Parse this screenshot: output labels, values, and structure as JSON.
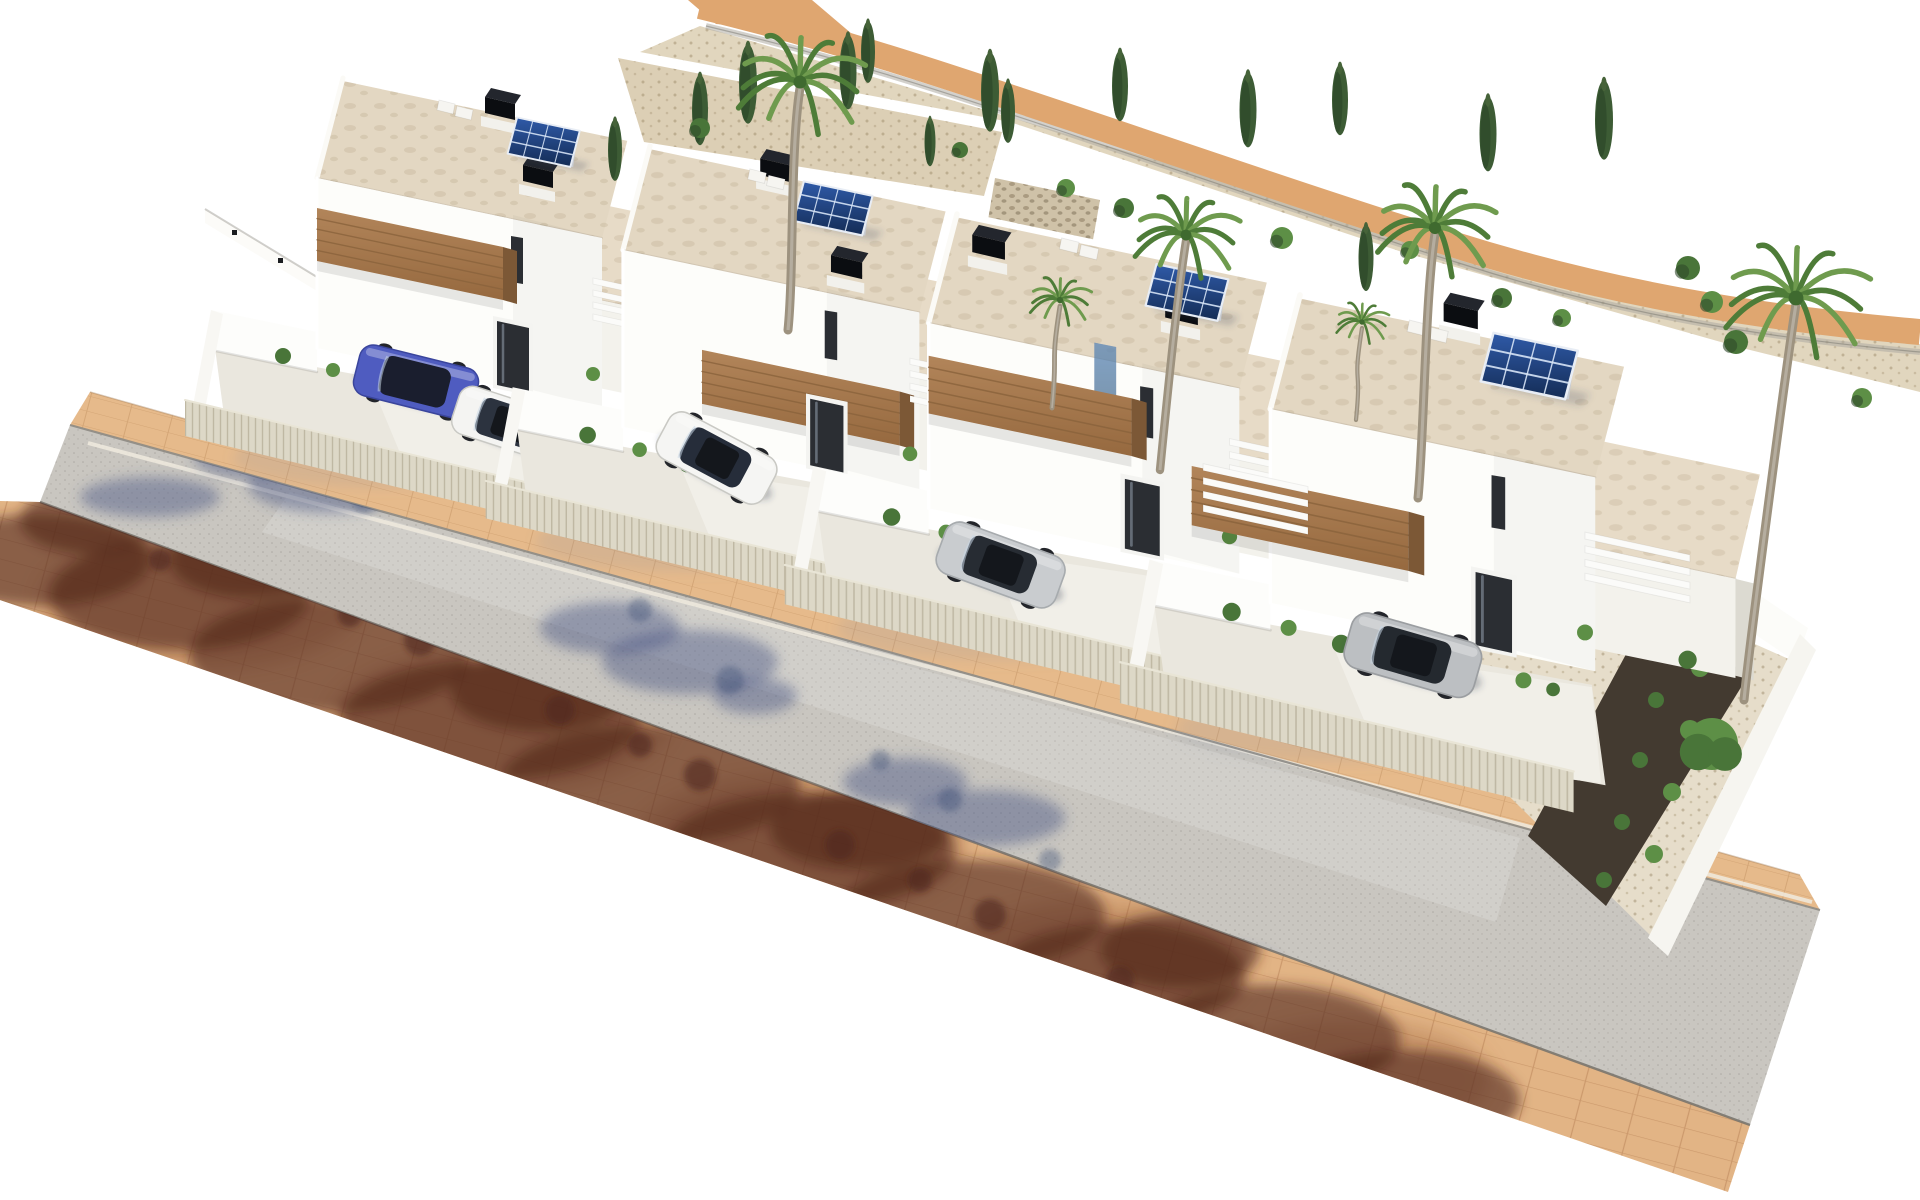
{
  "image": {
    "kind": "aerial-3d-architectural-render",
    "width": 1920,
    "height": 1200,
    "viewbox": "0 0 1920 1200",
    "background": "#ffffff"
  },
  "palette": {
    "roof1": "#e3d7c2",
    "roof2": "#e7dbc7",
    "wallBright": "#fdfdfa",
    "wallShade": "#f3f2ec",
    "wallDim": "#e9e7df",
    "alley": "#dcdad1",
    "woodTop": "#b2855a",
    "woodBottom": "#96693f",
    "woodSide": "#7c5836",
    "woodLine": "#8a633c",
    "doorDark": "#2b2e33",
    "doorFrame": "#f4f4f1",
    "glassBlue1": "#77a3c2",
    "glassBlue2": "#3f6f94",
    "floor": "#eae7de",
    "drive": "#f2f0e9",
    "fence": "#ddd8c7",
    "fenceEdge": "#e9e5d6",
    "road": "#c9c6c0",
    "sideTan": "#e6ba8b",
    "sideTan2": "#e2b485",
    "curbDark": "#8e8b84",
    "curbLight": "#f0ebdf",
    "roadEdge": "#75726b",
    "pathTan": "#dfa670",
    "gravel": "#ded1b7",
    "gravel2": "#dccfb5",
    "stone": "#cfc2a8",
    "darkBed": "#433a30",
    "chimTop": "#23262d",
    "chimFront": "#0b0d11",
    "chimBase": "#f2f1ec",
    "panelA": "#2f5aa8",
    "panelB": "#142c55",
    "panelFrame": "#e8edf5",
    "panelGrid": "rgba(215,228,246,0.9)",
    "palmLight": "#6f9b4e",
    "palmDark": "#4e7c38",
    "palmCore": "#3f6a2f",
    "trunk": "#9d927f",
    "cypress1": "#3d5c35",
    "cypress2": "#2e4829",
    "bush1": "#5d8f46",
    "bush2": "#497539",
    "shadowBlue": "rgba(70,85,130,0.45)",
    "shadowBlue2": "rgba(60,74,116,0.38)",
    "shadowBrown": "rgba(80,40,26,0.60)",
    "shadowRust": "rgba(150,88,55,0.35)",
    "yardShadow": "rgba(130,140,165,0.16)",
    "carShadow": "rgba(50,55,75,0.30)"
  },
  "street": {
    "tan_top": [
      [
        90,
        392
      ],
      [
        1800,
        875
      ],
      [
        1820,
        910
      ],
      [
        70,
        425
      ]
    ],
    "road": [
      [
        70,
        425
      ],
      [
        1820,
        910
      ],
      [
        1750,
        1125
      ],
      [
        40,
        502
      ]
    ],
    "tan_bottom": [
      [
        40,
        502
      ],
      [
        1750,
        1125
      ],
      [
        1728,
        1192
      ],
      [
        0,
        600
      ],
      [
        0,
        501
      ]
    ],
    "center_streak": [
      [
        290,
        492
      ],
      [
        1520,
        838
      ],
      [
        1496,
        922
      ],
      [
        262,
        532
      ]
    ],
    "curb_light": {
      "x1": 88,
      "y1": 443,
      "x2": 1812,
      "y2": 902
    },
    "curb_dark": {
      "x1": 70,
      "y1": 425,
      "x2": 1820,
      "y2": 910
    },
    "edge_low": {
      "x1": 40,
      "y1": 502,
      "x2": 1750,
      "y2": 1125
    },
    "edge_top": {
      "x1": 90,
      "y1": 392,
      "x2": 1800,
      "y2": 875
    },
    "paver_angle": 14.8
  },
  "shadows": {
    "road_blue": [
      [
        150,
        497,
        70,
        20
      ],
      [
        255,
        455,
        62,
        24
      ],
      [
        330,
        485,
        82,
        28
      ],
      [
        300,
        432,
        42,
        16
      ],
      [
        610,
        628,
        70,
        26
      ],
      [
        690,
        662,
        88,
        32
      ],
      [
        755,
        696,
        42,
        18
      ],
      [
        905,
        782,
        62,
        24
      ],
      [
        985,
        818,
        80,
        28
      ],
      [
        1215,
        972,
        68,
        26
      ],
      [
        1308,
        1018,
        88,
        32
      ],
      [
        1385,
        1062,
        44,
        20
      ],
      [
        1510,
        1092,
        60,
        22
      ]
    ],
    "road_leaf": [
      [
        205,
        440,
        12
      ],
      [
        365,
        500,
        13
      ],
      [
        640,
        610,
        12
      ],
      [
        730,
        680,
        14
      ],
      [
        950,
        800,
        12
      ],
      [
        1270,
        990,
        13
      ],
      [
        1360,
        1045,
        12
      ],
      [
        880,
        760,
        10
      ],
      [
        1050,
        860,
        11
      ]
    ],
    "side_rust": [
      [
        200,
        600,
        160,
        70
      ],
      [
        500,
        720,
        170,
        72
      ],
      [
        800,
        845,
        165,
        70
      ],
      [
        1100,
        965,
        150,
        65
      ],
      [
        1350,
        1080,
        140,
        60
      ]
    ],
    "side_brown": [
      [
        40,
        560,
        110,
        46
      ],
      [
        180,
        595,
        130,
        55
      ],
      [
        330,
        655,
        140,
        58
      ],
      [
        490,
        720,
        150,
        60
      ],
      [
        650,
        785,
        150,
        60
      ],
      [
        810,
        850,
        145,
        58
      ],
      [
        970,
        915,
        135,
        55
      ],
      [
        1120,
        975,
        125,
        52
      ],
      [
        1270,
        1040,
        130,
        55
      ],
      [
        1400,
        1100,
        120,
        50
      ],
      [
        90,
        520,
        70,
        34
      ],
      [
        250,
        560,
        80,
        38
      ],
      [
        540,
        690,
        90,
        42
      ],
      [
        860,
        830,
        90,
        40
      ],
      [
        1180,
        950,
        80,
        38
      ]
    ],
    "side_leaf": [
      [
        120,
        505,
        14
      ],
      [
        210,
        540,
        16
      ],
      [
        300,
        580,
        15
      ],
      [
        420,
        640,
        16
      ],
      [
        560,
        710,
        15
      ],
      [
        700,
        775,
        16
      ],
      [
        840,
        845,
        15
      ],
      [
        990,
        915,
        16
      ],
      [
        1120,
        980,
        14
      ],
      [
        1240,
        1040,
        15
      ],
      [
        160,
        560,
        11
      ],
      [
        350,
        615,
        12
      ],
      [
        640,
        745,
        12
      ],
      [
        920,
        880,
        12
      ],
      [
        1320,
        1075,
        13
      ],
      [
        1440,
        1120,
        12
      ]
    ]
  },
  "backdrop": {
    "path_d": "M700,6 C840,40 940,74 1030,104 C1180,154 1300,196 1452,244 C1610,294 1760,318 1920,332",
    "path_width": 26,
    "path_start": [
      [
        688,
        0
      ],
      [
        812,
        0
      ],
      [
        852,
        34
      ],
      [
        716,
        24
      ]
    ],
    "fence_d": "M706,26 C850,60 950,94 1040,124 C1190,174 1310,216 1462,264 C1618,314 1764,338 1920,352",
    "gravel_band": [
      [
        640,
        52
      ],
      [
        1010,
        122
      ],
      [
        1402,
        252
      ],
      [
        1742,
        348
      ],
      [
        1920,
        392
      ],
      [
        1920,
        344
      ],
      [
        1700,
        298
      ],
      [
        1430,
        240
      ],
      [
        1060,
        132
      ],
      [
        700,
        26
      ]
    ],
    "gravel_pocket": [
      [
        618,
        58
      ],
      [
        1002,
        132
      ],
      [
        984,
        196
      ],
      [
        644,
        142
      ]
    ],
    "gabion": [
      [
        995,
        178
      ],
      [
        1100,
        200
      ],
      [
        1082,
        302
      ],
      [
        978,
        280
      ]
    ],
    "left_wall_band": [
      [
        205,
        209
      ],
      [
        340,
        291
      ],
      [
        340,
        305
      ],
      [
        205,
        223
      ]
    ],
    "left_wall_dots": [
      [
        232,
        230
      ],
      [
        278,
        258
      ],
      [
        322,
        286
      ]
    ]
  },
  "right_garden": {
    "wall_back": [
      [
        1468,
        398
      ],
      [
        1808,
        628
      ],
      [
        1796,
        662
      ],
      [
        1456,
        432
      ]
    ],
    "wall_side": [
      [
        1800,
        634
      ],
      [
        1816,
        650
      ],
      [
        1668,
        956
      ],
      [
        1648,
        938
      ]
    ],
    "interior": [
      [
        1475,
        520
      ],
      [
        1800,
        664
      ],
      [
        1655,
        940
      ],
      [
        1452,
        740
      ]
    ],
    "dark_bed": [
      [
        1652,
        606
      ],
      [
        1748,
        676
      ],
      [
        1606,
        906
      ],
      [
        1528,
        836
      ]
    ],
    "bed_shrubs": [
      [
        1668,
        640,
        8
      ],
      [
        1700,
        668,
        9
      ],
      [
        1656,
        700,
        8
      ],
      [
        1690,
        730,
        10
      ],
      [
        1640,
        760,
        8
      ],
      [
        1672,
        792,
        9
      ],
      [
        1622,
        822,
        8
      ],
      [
        1654,
        854,
        9
      ],
      [
        1604,
        880,
        8
      ]
    ],
    "big_bush": [
      1712,
      744,
      26
    ]
  },
  "villa_template": {
    "tower_roof": [
      [
        0,
        0
      ],
      [
        285,
        60
      ],
      [
        259,
        160
      ],
      [
        -26,
        100
      ]
    ],
    "tower_face": [
      [
        -26,
        100
      ],
      [
        259,
        160
      ],
      [
        259,
        330
      ],
      [
        -26,
        270
      ]
    ],
    "face_shade": [
      [
        170,
        137
      ],
      [
        259,
        160
      ],
      [
        259,
        330
      ],
      [
        170,
        307
      ]
    ],
    "slit": [
      [
        168,
        158
      ],
      [
        180,
        160
      ],
      [
        180,
        206
      ],
      [
        168,
        204
      ]
    ],
    "balcony": [
      [
        -26,
        130
      ],
      [
        160,
        169
      ],
      [
        160,
        222
      ],
      [
        -26,
        183
      ]
    ],
    "door_frame": [
      [
        150,
        238
      ],
      [
        190,
        246
      ],
      [
        190,
        318
      ],
      [
        150,
        310
      ]
    ],
    "door_glass": [
      [
        154,
        243
      ],
      [
        186,
        250
      ],
      [
        186,
        314
      ],
      [
        154,
        307
      ]
    ],
    "low_roof": [
      [
        202,
        112
      ],
      [
        468,
        168
      ],
      [
        446,
        262
      ],
      [
        180,
        206
      ]
    ],
    "low_face": [
      [
        180,
        206
      ],
      [
        446,
        262
      ],
      [
        446,
        350
      ],
      [
        180,
        294
      ]
    ],
    "alley": [
      [
        446,
        262
      ],
      [
        462,
        266
      ],
      [
        462,
        352
      ],
      [
        446,
        348
      ]
    ],
    "back_wall": [
      [
        -132,
        232
      ],
      [
        -26,
        254
      ],
      [
        -26,
        294
      ],
      [
        -132,
        272
      ]
    ],
    "left_wall": [
      [
        -132,
        232
      ],
      [
        -152,
        338
      ],
      [
        -140,
        342
      ],
      [
        -120,
        236
      ]
    ],
    "floor": [
      [
        -128,
        270
      ],
      [
        256,
        342
      ],
      [
        268,
        430
      ],
      [
        -116,
        360
      ]
    ],
    "drive": [
      [
        30,
        310
      ],
      [
        256,
        344
      ],
      [
        264,
        428
      ],
      [
        70,
        406
      ]
    ],
    "fence": [
      [
        -158,
        322
      ],
      [
        240,
        418
      ],
      [
        240,
        454
      ],
      [
        -158,
        358
      ]
    ],
    "yard_shadow": [
      40,
      380,
      150,
      30
    ],
    "shrubs": [
      [
        -60,
        278,
        8
      ],
      [
        -10,
        292,
        7
      ],
      [
        36,
        306,
        8
      ],
      [
        196,
        338,
        7
      ],
      [
        222,
        346,
        6
      ],
      [
        250,
        296,
        7
      ],
      [
        340,
        320,
        8
      ],
      [
        88,
        322,
        5
      ]
    ],
    "ac_units": [
      [
        96,
        22
      ],
      [
        114,
        28
      ]
    ],
    "louver_len": 92,
    "louver_drop": 20,
    "louver_step": 12,
    "louver_bars": 4
  },
  "balcony_variants": {
    "B": [
      [
        50,
        196
      ],
      [
        240,
        236
      ],
      [
        240,
        288
      ],
      [
        50,
        248
      ]
    ],
    "C": [
      [
        -95,
        150
      ],
      [
        95,
        190
      ],
      [
        95,
        242
      ],
      [
        -95,
        202
      ]
    ]
  },
  "villas": [
    {
      "id": "villa-1",
      "x": 343,
      "y": 78,
      "s": 1.0,
      "chimneys": [
        [
          148,
          14
        ],
        [
          186,
          82
        ]
      ],
      "panel": [
        176,
        30
      ],
      "panel_s": 0.95,
      "louvers": [
        [
          250,
          200
        ]
      ],
      "cars": [
        {
          "cx": 73,
          "cy": 304,
          "rot": 14,
          "len": 122,
          "wid": 52,
          "color": "#4f5cc0",
          "stroke": "#3a459c",
          "glass": "#1a1e2e",
          "sunroof": false
        },
        {
          "cx": 167,
          "cy": 346,
          "rot": 18,
          "len": 114,
          "wid": 50,
          "color": "#f4f4f2",
          "stroke": "#c9c9c4",
          "glass": "#2c333f",
          "sunroof": true
        }
      ]
    },
    {
      "id": "villa-2",
      "x": 650,
      "y": 146,
      "s": 1.04,
      "chimneys": [
        [
          112,
          7
        ],
        [
          180,
          100
        ]
      ],
      "panel": [
        150,
        24
      ],
      "panel_s": 1.0,
      "balcony": "B",
      "louvers": [
        [
          250,
          204
        ]
      ],
      "cars": [
        {
          "cx": 64,
          "cy": 300,
          "rot": 28,
          "len": 116,
          "wid": 50,
          "color": "#f5f5f3",
          "stroke": "#c9c9c4",
          "glass": "#262d3a",
          "sunroof": true
        }
      ]
    },
    {
      "id": "villa-3",
      "x": 957,
      "y": 214,
      "s": 1.09,
      "chimneys": [
        [
          20,
          14
        ],
        [
          197,
          74
        ]
      ],
      "panel": [
        185,
        36
      ],
      "panel_s": 1.0,
      "louvers": [
        [
          250,
          206
        ]
      ],
      "glass_slit": [
        [
          126,
          118
        ],
        [
          146,
          122
        ],
        [
          146,
          175
        ],
        [
          126,
          171
        ]
      ],
      "cars": [
        {
          "cx": 40,
          "cy": 322,
          "rot": 20,
          "len": 116,
          "wid": 50,
          "color": "#c9cccf",
          "stroke": "#a7abae",
          "glass": "#272c33",
          "sunroof": true
        }
      ]
    },
    {
      "id": "villa-4",
      "x": 1300,
      "y": 295,
      "s": 1.14,
      "chimneys": [
        [
          132,
          2
        ]
      ],
      "panel": [
        172,
        22
      ],
      "panel_s": 1.12,
      "balcony": "C",
      "louvers": [
        [
          -85,
          148
        ],
        [
          250,
          208
        ]
      ],
      "low_roof": [
        [
          200,
          112
        ],
        [
          404,
          155
        ],
        [
          382,
          249
        ],
        [
          178,
          206
        ]
      ],
      "low_face": [
        [
          178,
          206
        ],
        [
          382,
          249
        ],
        [
          382,
          336
        ],
        [
          178,
          294
        ]
      ],
      "alley": [
        [
          382,
          249
        ],
        [
          398,
          253
        ],
        [
          398,
          338
        ],
        [
          382,
          334
        ]
      ],
      "cars": [
        {
          "cx": 99,
          "cy": 316,
          "rot": 16,
          "len": 118,
          "wid": 50,
          "color": "#bcbfc2",
          "stroke": "#9b9ea1",
          "glass": "#24292f",
          "sunroof": true
        }
      ]
    }
  ],
  "palms": [
    {
      "x": 800,
      "y": 82,
      "s": 1.45,
      "bx": 788,
      "by": 330
    },
    {
      "x": 1186,
      "y": 235,
      "s": 1.2,
      "bx": 1160,
      "by": 470
    },
    {
      "x": 1435,
      "y": 228,
      "s": 1.35,
      "bx": 1418,
      "by": 498
    },
    {
      "x": 1796,
      "y": 298,
      "s": 1.65,
      "bx": 1744,
      "by": 700
    },
    {
      "x": 1060,
      "y": 300,
      "s": 0.7,
      "bx": 1052,
      "by": 408
    },
    {
      "x": 1362,
      "y": 322,
      "s": 0.6,
      "bx": 1356,
      "by": 420
    }
  ],
  "cypresses": [
    [
      700,
      110,
      0.8
    ],
    [
      748,
      84,
      0.9
    ],
    [
      848,
      72,
      0.85
    ],
    [
      868,
      52,
      0.7
    ],
    [
      990,
      92,
      0.9
    ],
    [
      1008,
      112,
      0.7
    ],
    [
      1120,
      86,
      0.8
    ],
    [
      1248,
      110,
      0.85
    ],
    [
      615,
      150,
      0.7
    ],
    [
      1340,
      100,
      0.8
    ],
    [
      1366,
      258,
      0.75
    ],
    [
      1488,
      134,
      0.85
    ],
    [
      1604,
      120,
      0.9
    ],
    [
      930,
      142,
      0.55
    ]
  ],
  "back_bushes": [
    [
      700,
      128,
      10
    ],
    [
      1066,
      188,
      9
    ],
    [
      1124,
      208,
      10
    ],
    [
      1282,
      238,
      11
    ],
    [
      1502,
      298,
      10
    ],
    [
      1562,
      318,
      9
    ],
    [
      1688,
      268,
      12
    ],
    [
      1712,
      302,
      11
    ],
    [
      1736,
      342,
      12
    ],
    [
      1862,
      398,
      10
    ],
    [
      960,
      150,
      8
    ],
    [
      1410,
      250,
      9
    ]
  ]
}
